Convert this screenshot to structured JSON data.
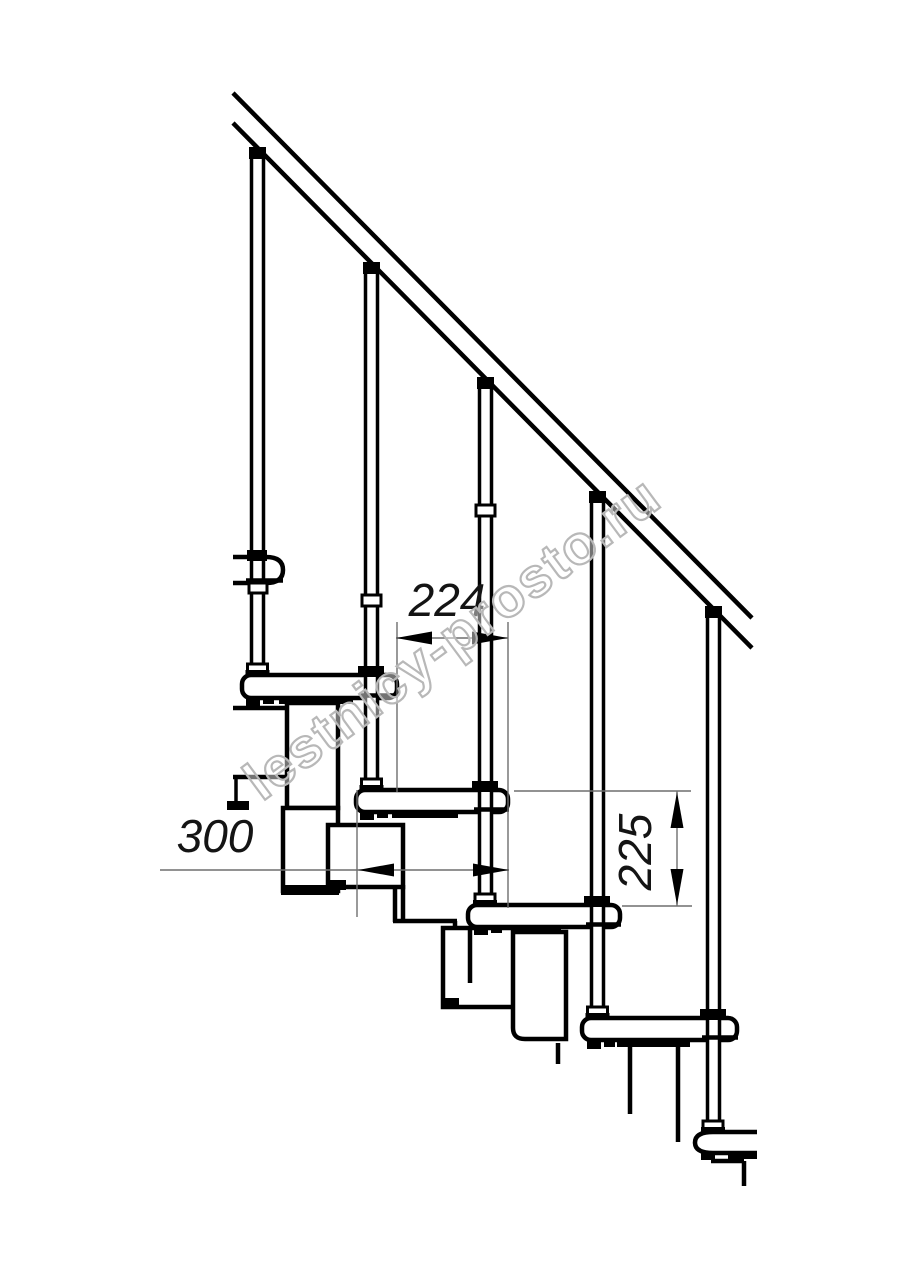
{
  "document": {
    "type": "technical engineering drawing",
    "subject": "modular staircase side elevation",
    "background_color": "#ffffff",
    "line_color": "#000000",
    "dimension_line_color": "#6e6e6e",
    "dimension_text_color": "#141414"
  },
  "dimensions": [
    {
      "id": "step-run",
      "label": "224",
      "orientation": "horizontal"
    },
    {
      "id": "tread-depth",
      "label": "300",
      "orientation": "horizontal"
    },
    {
      "id": "step-rise",
      "label": "225",
      "orientation": "vertical"
    }
  ],
  "watermark": {
    "text": "lestnicy-prosto.ru",
    "color": "#b8b8b8"
  },
  "structure": {
    "treads_visible": 6,
    "balusters_visible": 5,
    "handrail_visible": true
  }
}
